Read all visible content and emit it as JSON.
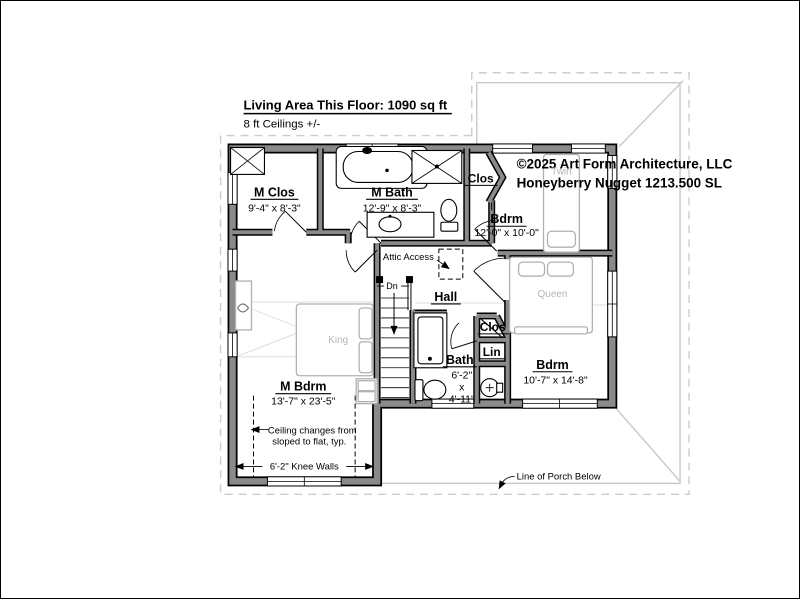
{
  "header": {
    "title": "Living Area This Floor: 1090 sq ft",
    "subtitle": "8 ft Ceilings +/-"
  },
  "copyright": {
    "line1": "©2025 Art Form Architecture, LLC",
    "line2": "Honeyberry Nugget 1213.500 SL"
  },
  "rooms": {
    "m_clos": {
      "name": "M Clos",
      "dims": "9'-4\" x 8'-3\""
    },
    "m_bath": {
      "name": "M Bath",
      "dims": "12'-9\" x 8'-3\""
    },
    "clos_top": {
      "name": "Clos"
    },
    "bdrm_twin": {
      "name": "Bdrm",
      "dims": "12'-0\" x 10'-0\""
    },
    "hall": {
      "name": "Hall"
    },
    "bath": {
      "name": "Bath",
      "dim_w": "6'-2\"",
      "dim_x": "x",
      "dim_h": "4'-11\""
    },
    "clos_small": {
      "name": "Clos"
    },
    "lin": {
      "name": "Lin"
    },
    "bdrm_queen": {
      "name": "Bdrm",
      "dims": "10'-7\" x 14'-8\""
    },
    "m_bdrm": {
      "name": "M Bdrm",
      "dims": "13'-7\" x 23'-5\""
    }
  },
  "furniture": {
    "king": "King",
    "queen": "Queen",
    "twin": "Twin"
  },
  "annotations": {
    "attic": "Attic Access",
    "dn": "Dn",
    "ceiling_line1": "Ceiling changes from",
    "ceiling_line2": "sloped to flat, typ.",
    "knee_walls": "6'-2\" Knee Walls",
    "porch": "Line of Porch Below"
  },
  "colors": {
    "wall_fill": "#8a8a8a",
    "wall_edge": "#000000",
    "roof_line": "#c9c9c9",
    "furniture_line": "#b0b0b0",
    "text": "#000000"
  }
}
